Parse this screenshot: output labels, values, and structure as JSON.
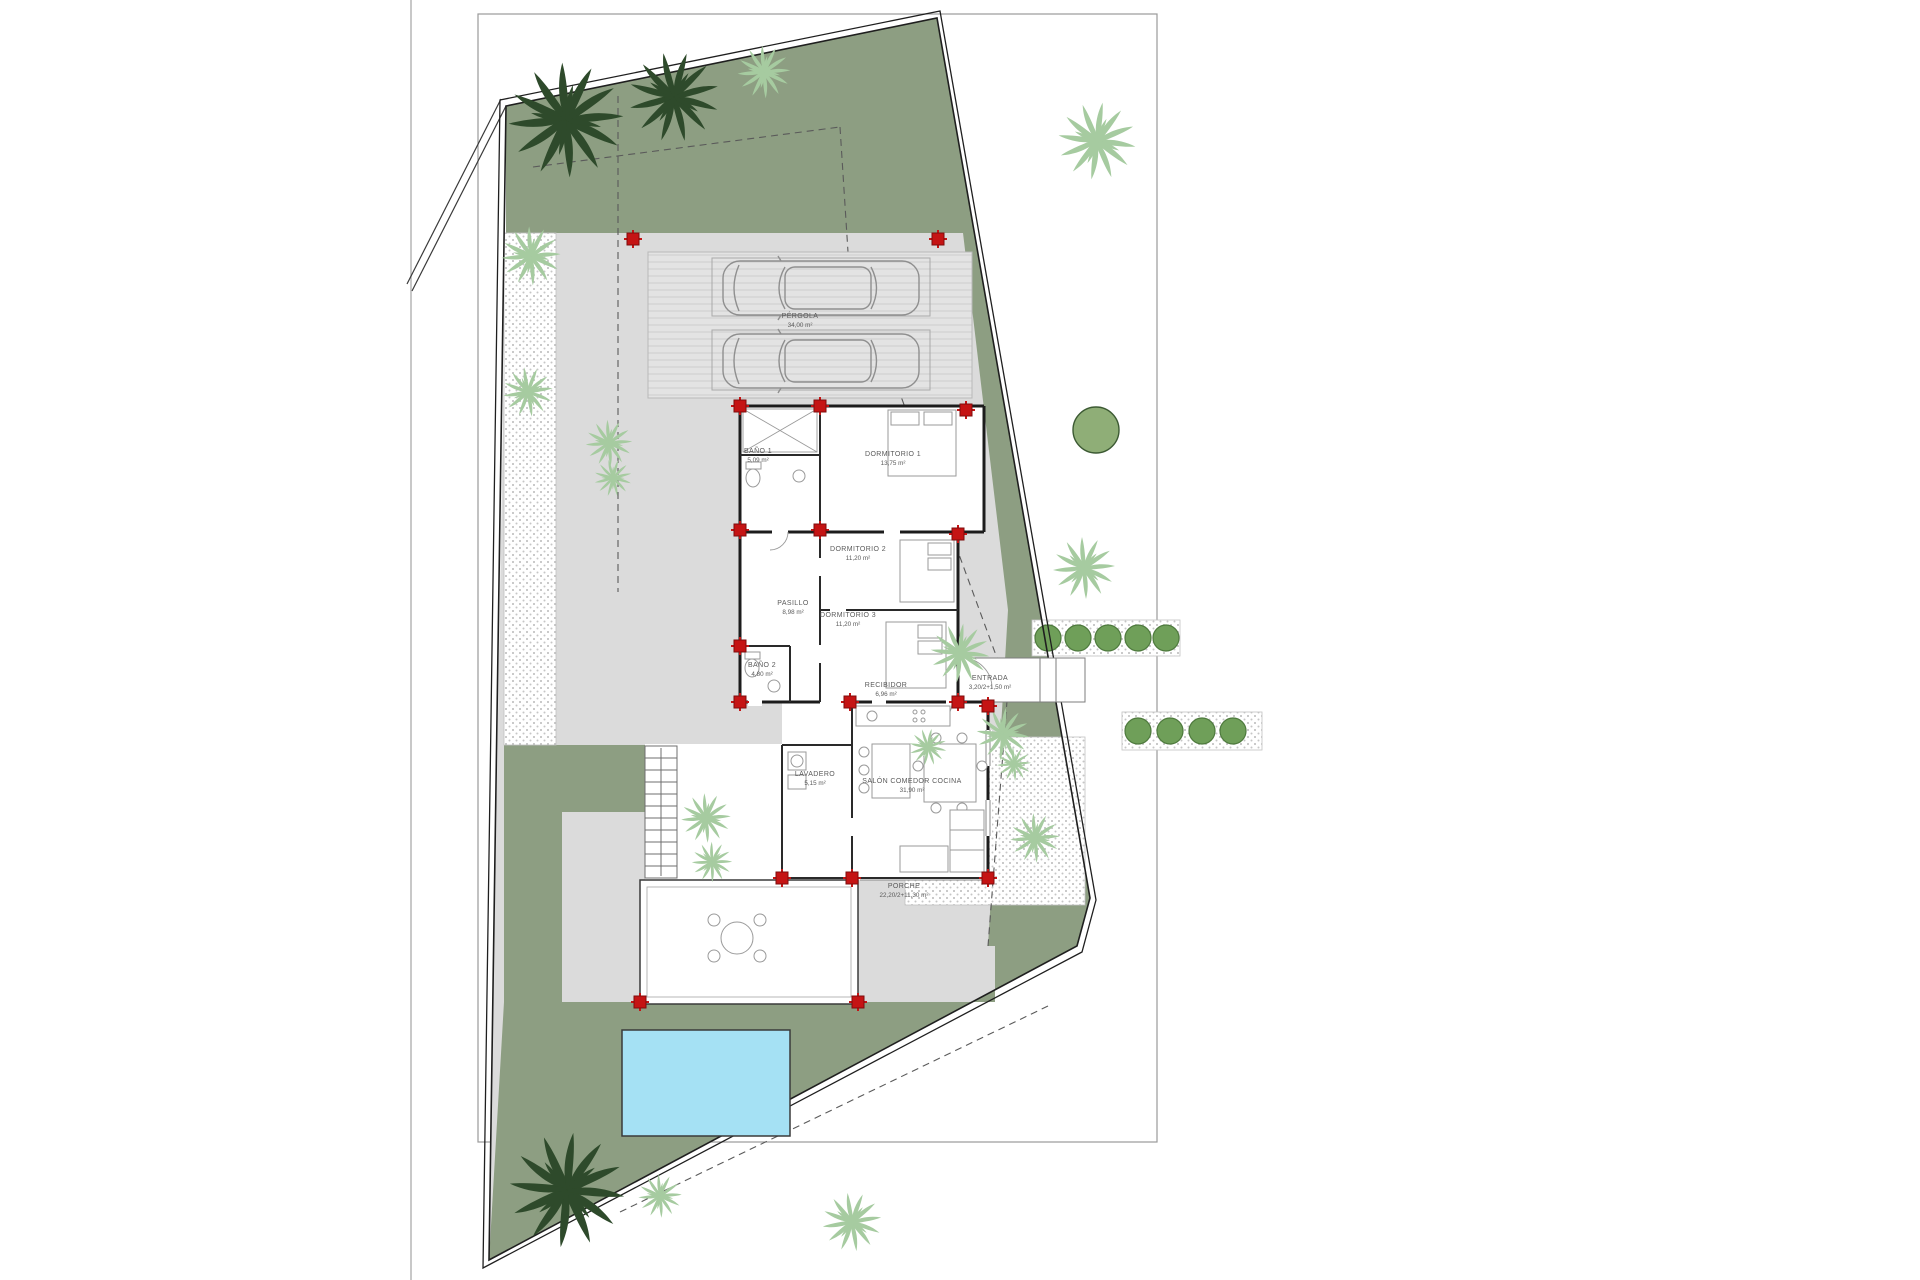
{
  "plan": {
    "rooms": [
      {
        "id": "pergola",
        "name": "PÉRGOLA",
        "area": "34,00 m²"
      },
      {
        "id": "bano1",
        "name": "BAÑO 1",
        "area": "5,09 m²"
      },
      {
        "id": "dormitorio1",
        "name": "DORMITORIO 1",
        "area": "13,75 m²"
      },
      {
        "id": "dormitorio2",
        "name": "DORMITORIO 2",
        "area": "11,20 m²"
      },
      {
        "id": "pasillo",
        "name": "PASILLO",
        "area": "8,98 m²"
      },
      {
        "id": "dormitorio3",
        "name": "DORMITORIO 3",
        "area": "11,20 m²"
      },
      {
        "id": "bano2",
        "name": "BAÑO 2",
        "area": "4,80 m²"
      },
      {
        "id": "recibidor",
        "name": "RECIBIDOR",
        "area": "6,96 m²"
      },
      {
        "id": "entrada",
        "name": "ENTRADA",
        "area": "3,20/2+1,50 m²"
      },
      {
        "id": "lavadero",
        "name": "LAVADERO",
        "area": "5,15 m²"
      },
      {
        "id": "salon",
        "name": "SALÓN COMEDOR COCINA",
        "area": "31,90 m²"
      },
      {
        "id": "porche",
        "name": "PORCHE",
        "area": "22,20/2+11,30 m²"
      }
    ],
    "colors": {
      "garden_green": "#8d9e82",
      "paving_gray": "#dbdbdb",
      "pool_blue": "#a5e1f4",
      "pillar_red": "#c51414",
      "wall_black": "#1c1c1c",
      "bush_green": "#6f9f59",
      "palm_dark": "#2e4a2b",
      "palm_light": "#a6cba0"
    },
    "icons": [
      "palm-tree-icon",
      "car-icon",
      "column-marker-icon",
      "bush-icon",
      "tree-icon",
      "stairs-icon",
      "pool",
      "bed-icon",
      "sofa-icon",
      "dining-table-icon",
      "toilet-icon",
      "washer-icon"
    ]
  }
}
